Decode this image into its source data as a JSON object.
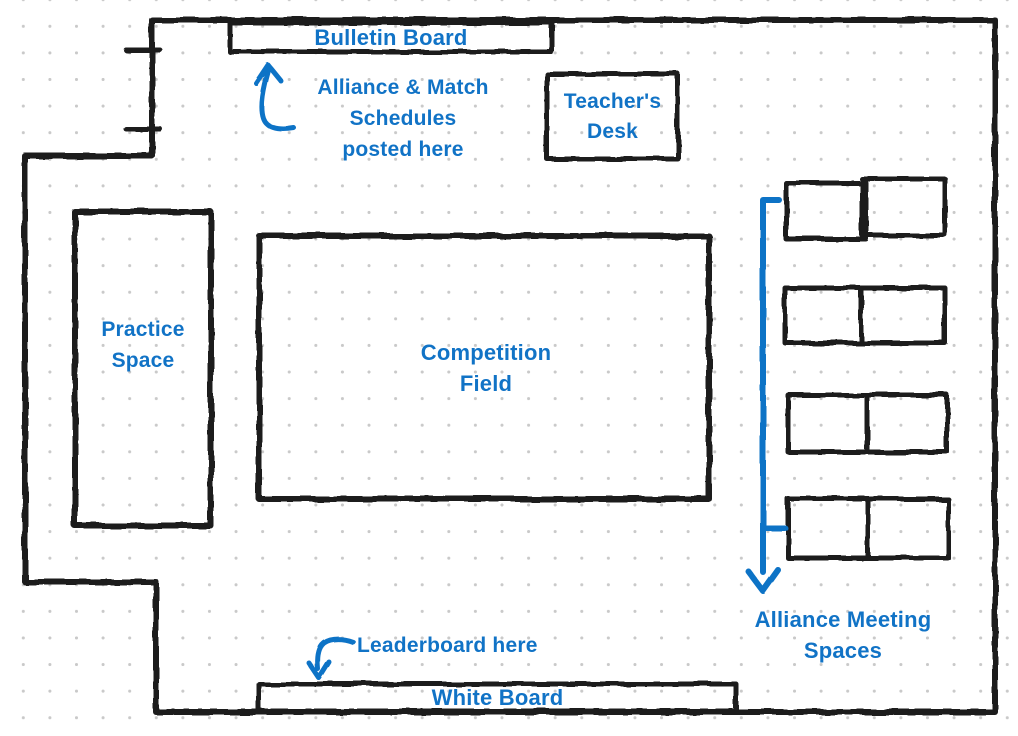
{
  "colors": {
    "accent": "#1173c6",
    "wall": "#1e1e1e",
    "grid_dot": "#c9c9c9"
  },
  "labels": {
    "bulletin_board": "Bulletin Board",
    "schedules_note_line1": "Alliance & Match",
    "schedules_note_line2": "Schedules",
    "schedules_note_line3": "posted here",
    "teachers_desk_line1": "Teacher's",
    "teachers_desk_line2": "Desk",
    "practice_space_line1": "Practice",
    "practice_space_line2": "Space",
    "competition_field_line1": "Competition",
    "competition_field_line2": "Field",
    "alliance_meeting_line1": "Alliance Meeting",
    "alliance_meeting_line2": "Spaces",
    "leaderboard_note": "Leaderboard here",
    "white_board": "White Board"
  },
  "icons": {
    "up_arrow": "up-arrow-icon",
    "down_arrow": "down-arrow-icon",
    "hook_down_arrow": "hook-down-arrow-icon",
    "door_marks": "door-tick-marks"
  }
}
